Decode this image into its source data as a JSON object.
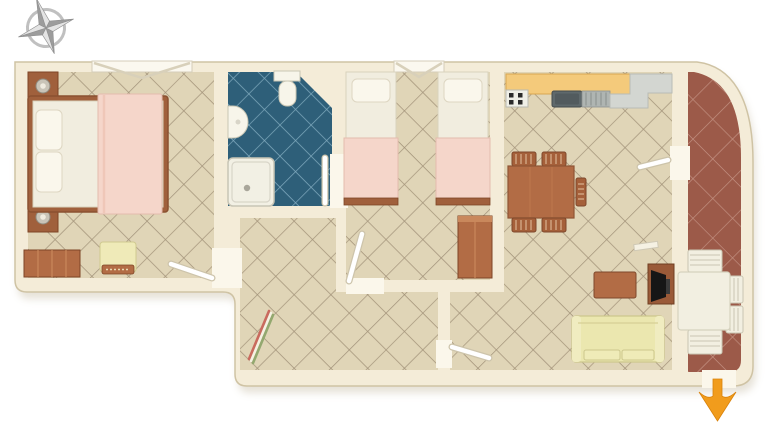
{
  "scene": {
    "kind": "apartment-floor-plan",
    "view": "top-down-3d-render",
    "compass": "compass-rose-top-left",
    "entrance_indicator": {
      "shape": "arrow",
      "direction": "down",
      "position": "bottom-right"
    }
  },
  "rooms": [
    {
      "name": "master-bedroom",
      "floor": "beige-diagonal-tile",
      "furniture": [
        "double-bed-with-pink-blanket",
        "nightstand-with-lamp",
        "nightstand-with-lamp",
        "dresser",
        "armchair"
      ],
      "features": [
        "casement-window-top",
        "door-bottom-right"
      ]
    },
    {
      "name": "bathroom",
      "floor": "teal-diagonal-tile",
      "furniture": [
        "toilet",
        "washbasin",
        "shower"
      ],
      "features": [
        "chamfered-corner",
        "door-right"
      ]
    },
    {
      "name": "twin-bedroom",
      "floor": "beige-diagonal-tile",
      "furniture": [
        "single-bed-with-pink-blanket",
        "single-bed-with-pink-blanket",
        "wardrobe"
      ],
      "features": [
        "casement-window-top",
        "door-bottom-left"
      ]
    },
    {
      "name": "kitchen-living-room",
      "floor": "beige-diagonal-tile",
      "furniture": [
        "kitchen-counter-orange",
        "stove",
        "sink-with-drainer",
        "counter-gray",
        "dining-table",
        "dining-chair",
        "dining-chair",
        "dining-chair",
        "dining-chair",
        "dining-chair",
        "coffee-table",
        "tv-stand-with-tv",
        "sofa-yellow",
        "wall-shelf"
      ],
      "features": [
        "door-to-terrace",
        "door-to-hallway"
      ]
    },
    {
      "name": "hallway",
      "floor": "beige-diagonal-tile",
      "furniture": [
        "striped-leaning-object"
      ],
      "features": []
    },
    {
      "name": "terrace",
      "floor": "terracotta-diagonal-tile",
      "furniture": [
        "outdoor-table-white",
        "outdoor-chair",
        "outdoor-chair",
        "outdoor-chair",
        "outdoor-chair"
      ],
      "features": [
        "rounded-outer-corner",
        "entrance-opening-bottom"
      ]
    }
  ],
  "colors": {
    "background": "#ffffff",
    "wall": "#F4ECD8",
    "wall_stroke": "#CFC3A4",
    "shadow": "#C9BFA8",
    "doorway": "#FBF7EB",
    "door_leaf": "#FFFFFF",
    "door_leaf_edge": "#CDC4AB",
    "floor_beige": "#E0D5B7",
    "grout_beige": "#A3937A",
    "floor_teal": "#2E5F79",
    "grout_teal": "#7FA9BD",
    "floor_terra": "#9C5A49",
    "grout_terra": "#C49384",
    "wood_dark": "#A0603C",
    "wood_mid": "#B26C45",
    "wood_light": "#C9885C",
    "wood_stroke": "#7E4526",
    "linen": "#F1EDDF",
    "pillow": "#FAF7EC",
    "blanket_pink": "#F5D6CA",
    "blanket_edge": "#E4BCAE",
    "sofa_yellow": "#EBE7AF",
    "sofa_stroke": "#CCC78D",
    "counter_orange": "#F4CA7B",
    "counter_orange_stroke": "#D9A751",
    "counter_gray": "#D3D6D1",
    "counter_gray_stroke": "#B8BCB6",
    "stove_white": "#EFEFE7",
    "burner_dark": "#2A2A2A",
    "sink_dark": "#5F696C",
    "drainer_gray": "#AFB5B2",
    "fixture_white": "#F7F5EA",
    "fixture_stroke": "#C9C6B4",
    "outdoor_white": "#F2EFE1",
    "outdoor_stroke": "#C9C5B2",
    "tv_black": "#161616",
    "arrow_orange": "#F19C1C",
    "compass_light": "#E4E4E4",
    "compass_dark": "#9C9C9C",
    "compass_ring": "#B5B5B5",
    "stripe_red": "#C96A5E",
    "stripe_green": "#93A86F",
    "lamp_gray": "#C9C4B8",
    "chair_slat": "#E2C2A0"
  }
}
